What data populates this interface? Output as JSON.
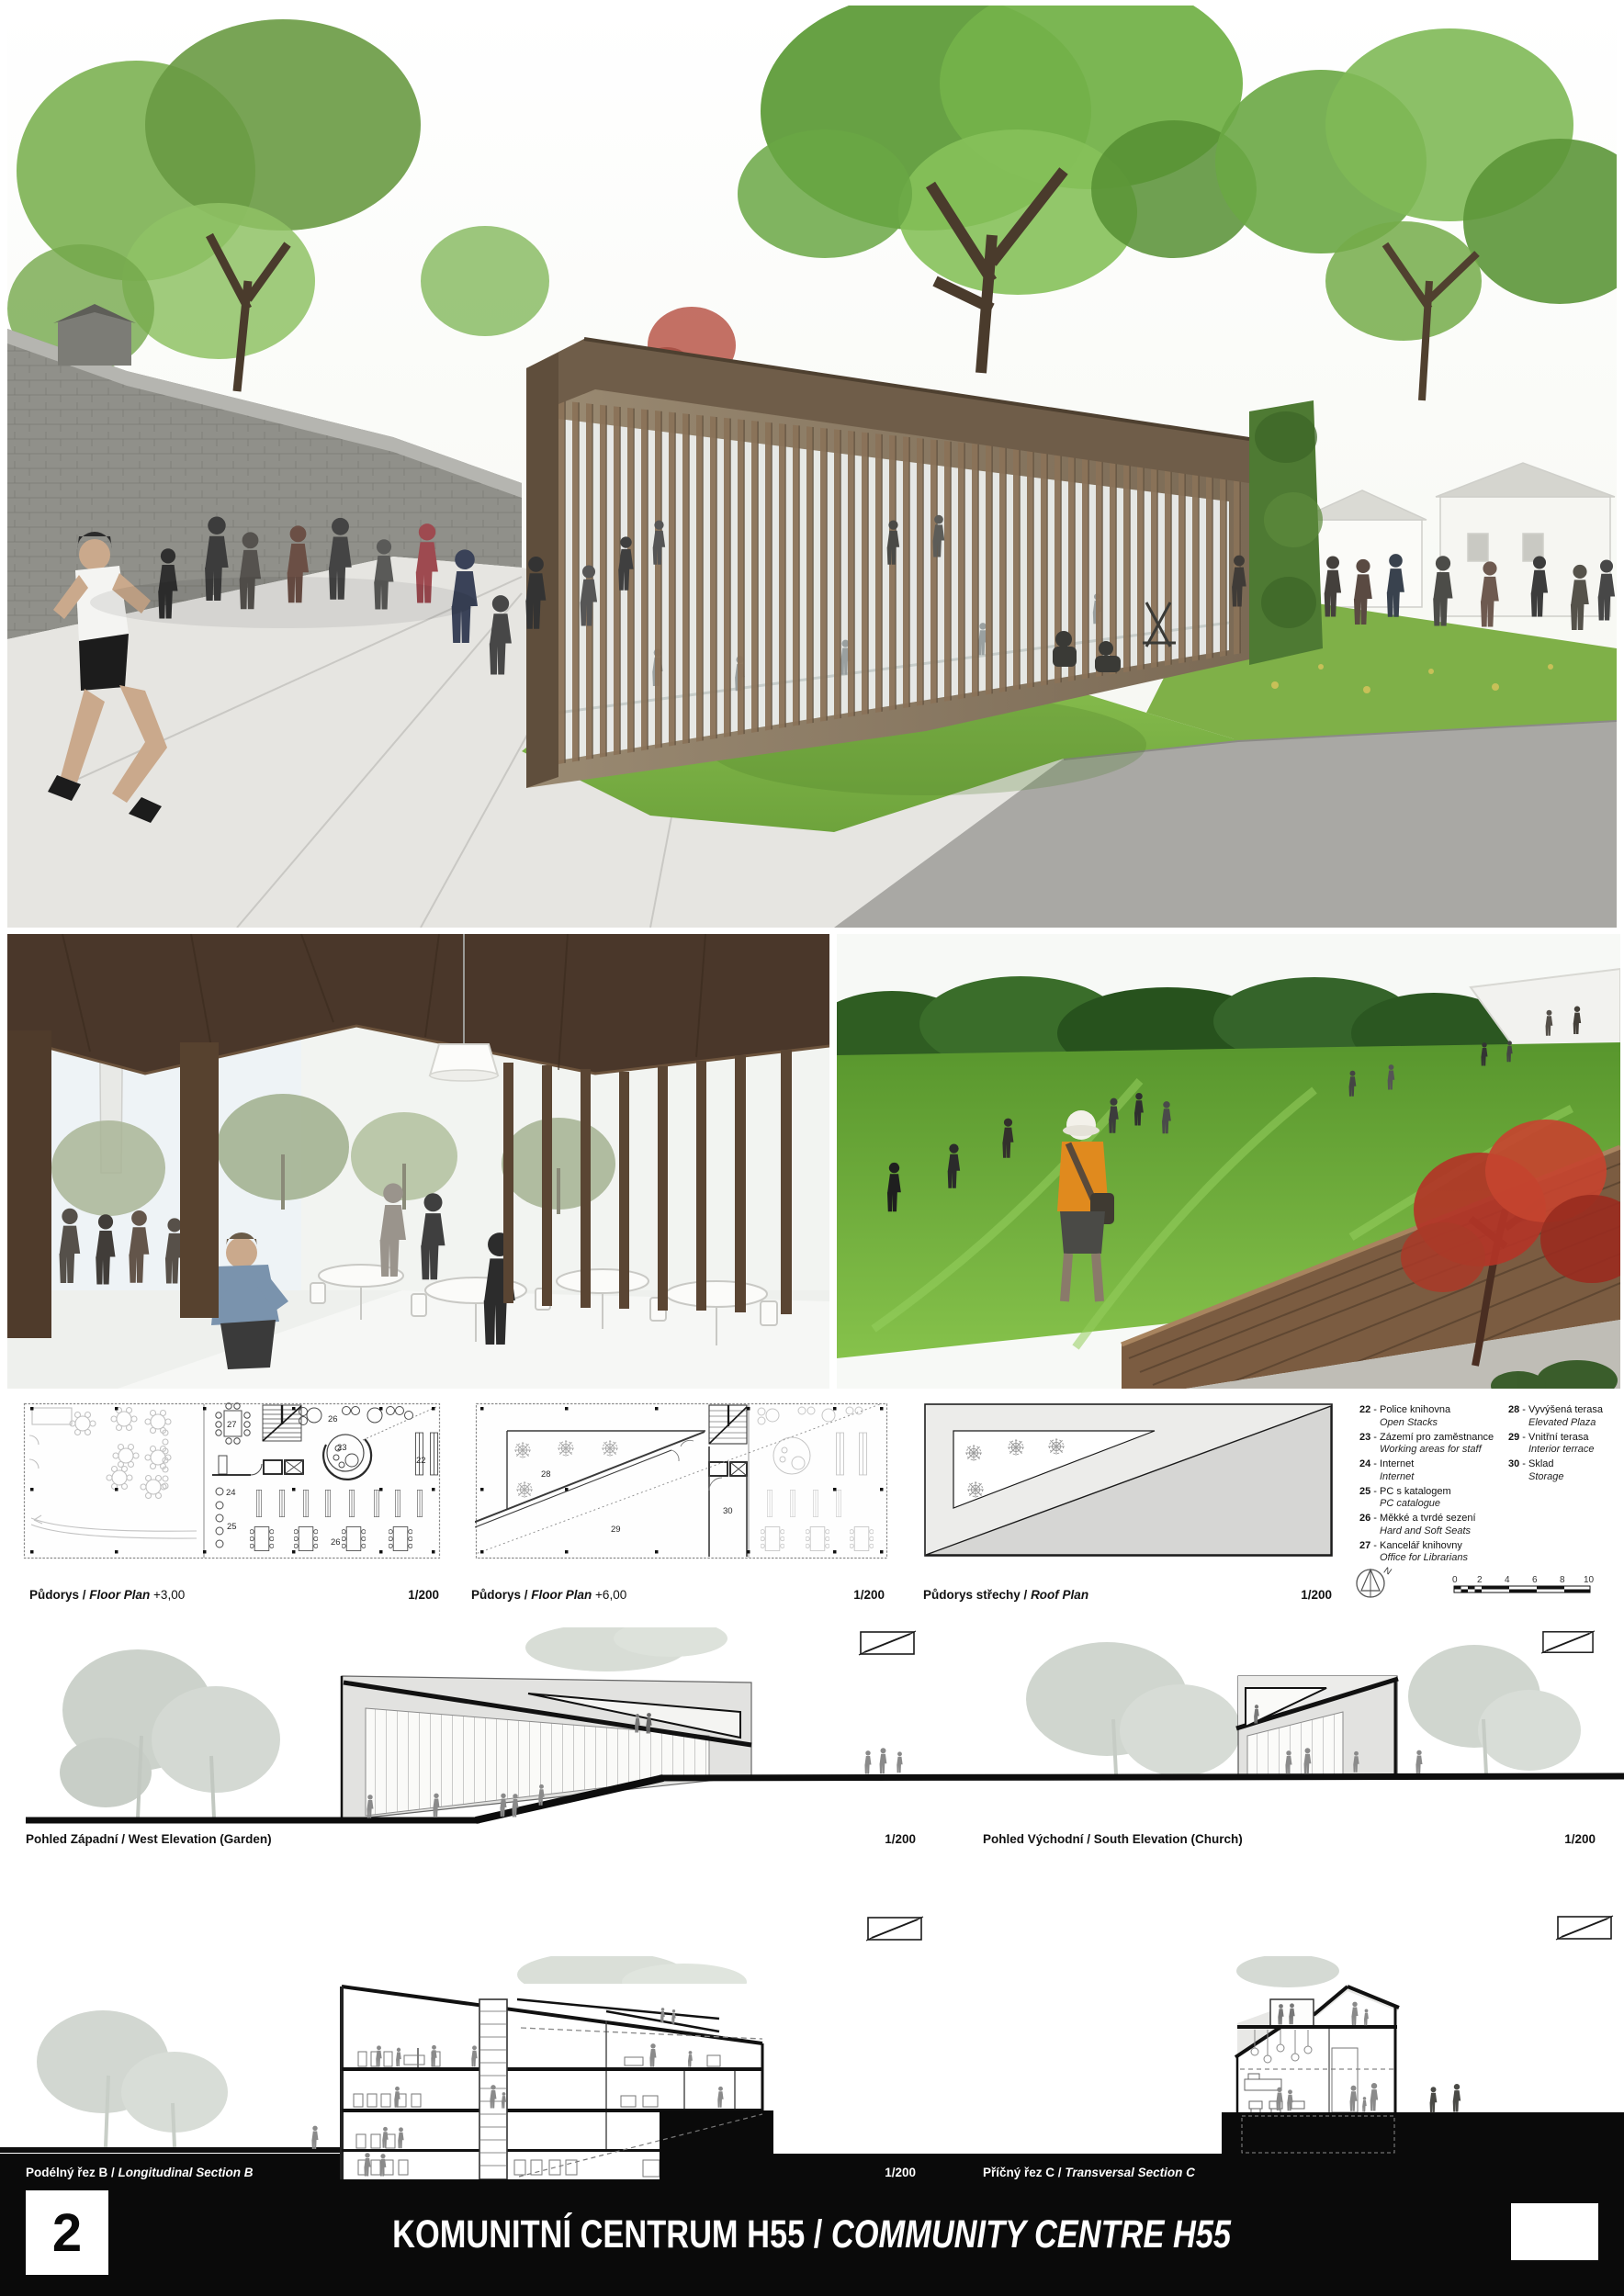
{
  "board": {
    "page_number": "2",
    "title": {
      "cs": "KOMUNITNÍ CENTRUM H55",
      "sep": " / ",
      "en": "COMMUNITY CENTRE H55"
    }
  },
  "plans": [
    {
      "cs": "Půdorys",
      "sep": " / ",
      "en": "Floor Plan",
      "suffix": " +3,00",
      "scale": "1/200"
    },
    {
      "cs": "Půdorys",
      "sep": " / ",
      "en": "Floor Plan",
      "suffix": " +6,00",
      "scale": "1/200"
    },
    {
      "cs": "Půdorys střechy",
      "sep": " / ",
      "en": "Roof Plan",
      "suffix": "",
      "scale": "1/200"
    }
  ],
  "legend": {
    "col1": [
      {
        "num": "22",
        "sep": " - ",
        "cs": "Police knihovna",
        "en": "Open Stacks"
      },
      {
        "num": "23",
        "sep": " - ",
        "cs": "Zázemí pro zaměstnance",
        "en": "Working areas for staff"
      },
      {
        "num": "24",
        "sep": " - ",
        "cs": "Internet",
        "en": "Internet"
      },
      {
        "num": "25",
        "sep": " - ",
        "cs": "PC s katalogem",
        "en": "PC catalogue"
      },
      {
        "num": "26",
        "sep": " - ",
        "cs": "Měkké a tvrdé sezení",
        "en": "Hard and Soft Seats"
      },
      {
        "num": "27",
        "sep": " - ",
        "cs": "Kancelář knihovny",
        "en": "Office for Librarians"
      }
    ],
    "col2": [
      {
        "num": "28",
        "sep": " - ",
        "cs": "Vyvýšená terasa",
        "en": "Elevated Plaza"
      },
      {
        "num": "29",
        "sep": " - ",
        "cs": "Vnitřní terasa",
        "en": "Interior terrace"
      },
      {
        "num": "30",
        "sep": " - ",
        "cs": "Sklad",
        "en": "Storage"
      }
    ]
  },
  "rooms": {
    "p1": [
      "27",
      "23",
      "26",
      "22",
      "24",
      "25",
      "26"
    ],
    "p2": [
      "28",
      "29",
      "30"
    ]
  },
  "compass": {
    "label": "N"
  },
  "scalebar": {
    "ticks": [
      "0",
      "2",
      "4",
      "6",
      "8",
      "10"
    ]
  },
  "elevations": [
    {
      "cs": "Pohled Západní",
      "sep": " / ",
      "en": "West Elevation (Garden)",
      "scale": "1/200"
    },
    {
      "cs": "Pohled Východní",
      "sep": " / ",
      "en": "South Elevation (Church)",
      "scale": "1/200"
    }
  ],
  "sections": [
    {
      "cs": "Podélný řez B",
      "sep": " / ",
      "en": "Longitudinal Section B",
      "scale": "1/200"
    },
    {
      "cs": "Příčný řez C",
      "sep": " / ",
      "en": "Transversal Section C",
      "scale": "1/200"
    }
  ],
  "colors": {
    "accent_black": "#0a0a0a",
    "wood": "#8a7258",
    "meadow_green": "#6aad37",
    "tree_green": "#6fae4a",
    "drawing_grey": "#d8d8d6"
  }
}
